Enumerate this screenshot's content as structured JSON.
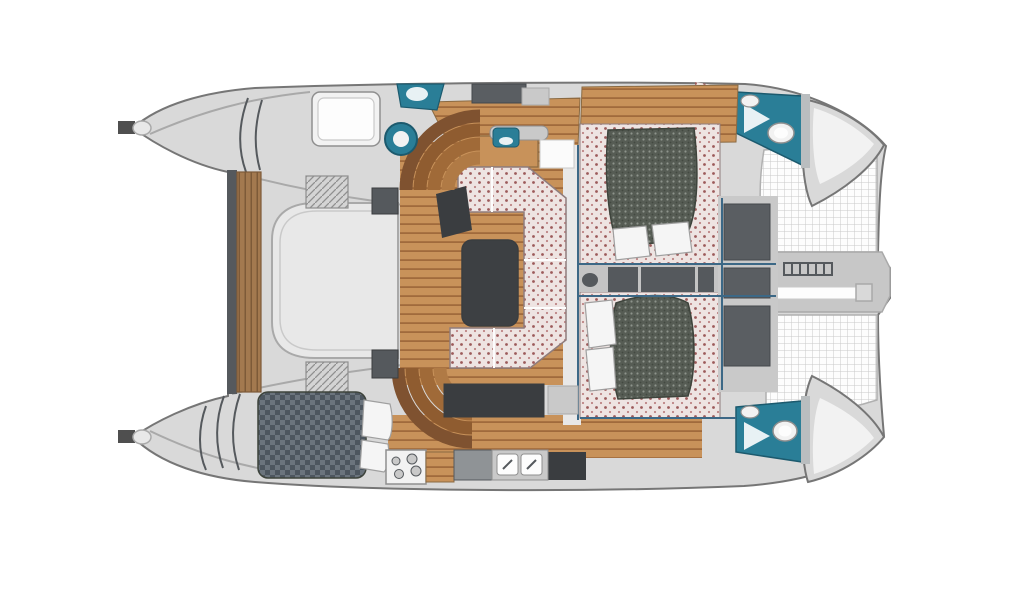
{
  "diagram": {
    "type": "catamaran-floor-plan",
    "view": "top-down",
    "bow_direction": "right",
    "stern_direction": "left"
  },
  "features": [
    {
      "id": "salon",
      "name": "salon with U-shaped settee and dinette table"
    },
    {
      "id": "dinette-table",
      "name": "dark dinette table"
    },
    {
      "id": "galley",
      "name": "galley with 4-burner stove, counters and twin sinks"
    },
    {
      "id": "cabin-forward-starboard",
      "name": "forward double cabin, starboard side"
    },
    {
      "id": "cabin-forward-port",
      "name": "forward double cabin, port side"
    },
    {
      "id": "cabin-aft-port",
      "name": "aft double berth in port hull"
    },
    {
      "id": "berth-aft-starboard",
      "name": "aft berth / deck hatch, starboard hull"
    },
    {
      "id": "head-starboard",
      "name": "bathroom head with toilet and sink, starboard bow"
    },
    {
      "id": "head-port",
      "name": "bathroom head with toilet and sink, port bow"
    },
    {
      "id": "cockpit-lounge",
      "name": "aft cockpit lounge seat"
    },
    {
      "id": "transom-bench",
      "name": "teak transom bench between hulls"
    },
    {
      "id": "trampoline-top",
      "name": "bow trampoline net, starboard"
    },
    {
      "id": "trampoline-bottom",
      "name": "bow trampoline net, port"
    },
    {
      "id": "bow-platform",
      "name": "anchor platform with ladder and bowsprit"
    },
    {
      "id": "stairs",
      "name": "curved companionway steps to each hull"
    },
    {
      "id": "winch",
      "name": "deck winch"
    },
    {
      "id": "deck-hatches",
      "name": "dark deck hatches"
    }
  ],
  "colors": {
    "background": "#ffffff",
    "deck": "#d9d9d9",
    "deck_light": "#e8e8e8",
    "deck_mid": "#c9c9c9",
    "outline": "#767676",
    "line_soft": "#a9a9a9",
    "wood": "#c8925a",
    "wood_line": "#a06a3c",
    "wood_edge": "#8a6a42",
    "teak": "#a3794f",
    "teak_line": "#7d5a38",
    "upholstery": "#eee4e2",
    "upholstery_dot": "#9c5a5a",
    "upholstery_dot2": "#bd8484",
    "upholstery_edge": "#8f7d7d",
    "mattress": "#565c54",
    "mattress_dot": "#8d938b",
    "mattress_dot2": "#434941",
    "mattress_edge": "#3e443c",
    "checker": "#4d565f",
    "checker_alt": "#6b747d",
    "dark": "#3a3d40",
    "dark_soft": "#55595d",
    "counter_gray": "#8f9396",
    "teal": "#2a7e97",
    "teal_dark": "#1c5a6e",
    "fixture": "#f2f2f2",
    "fixture_edge": "#8f8f8f",
    "pillow": "#f5f5f5",
    "pillow_edge": "#9f9f9f",
    "net_line": "#c9c9c9",
    "net_edge": "#b0b0b0",
    "platform": "#c7c7c7",
    "hatch_seat": "#d4d4d4",
    "hatch_seat_line": "#8f8f8f",
    "bulkhead_blue": "#3c6886",
    "wall_gray": "#b9bdbf",
    "white": "#fdfdfd",
    "glow": "#fbfbfb",
    "step1": "#b07a45",
    "step2": "#a06a38",
    "step3": "#8f5c30",
    "step4": "#7f5230",
    "cleat": "#4f4f4f",
    "partition": "#e8f1f4",
    "table": "#3d4043",
    "corridor": "#c4c4c4",
    "hatch_dark": "#5a5e62",
    "hatch_dark_edge": "#44484c"
  }
}
